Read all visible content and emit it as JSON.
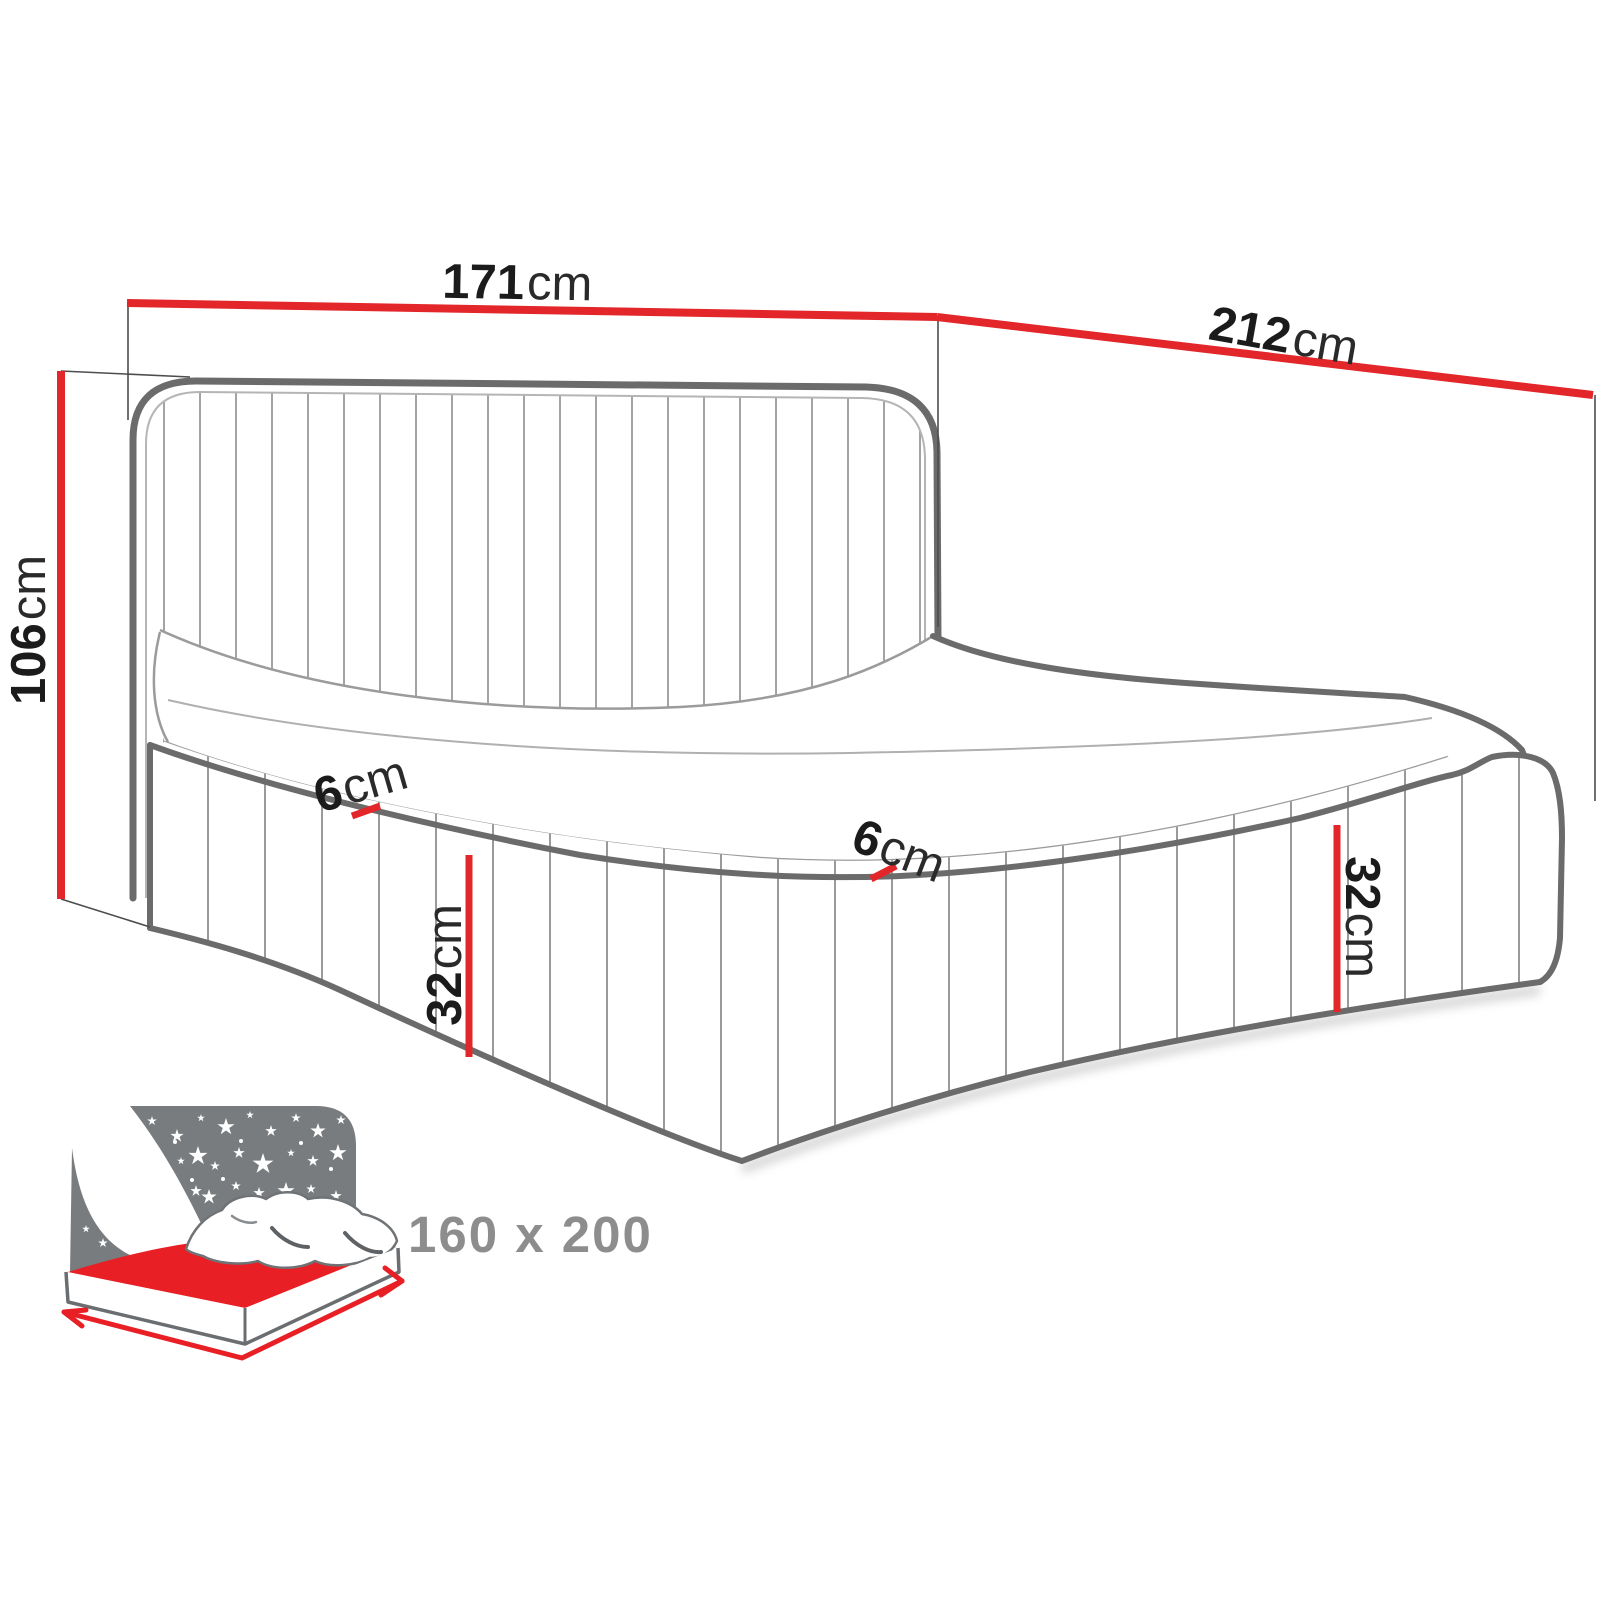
{
  "diagram": {
    "title": "bed-dimension-diagram",
    "dimensions": {
      "width": {
        "value": "171",
        "unit": "cm"
      },
      "length": {
        "value": "212",
        "unit": "cm"
      },
      "height": {
        "value": "106",
        "unit": "cm"
      },
      "rail_left": {
        "value": "6",
        "unit": "cm"
      },
      "rail_right": {
        "value": "6",
        "unit": "cm"
      },
      "frame_left": {
        "value": "32",
        "unit": "cm"
      },
      "frame_right": {
        "value": "32",
        "unit": "cm"
      }
    },
    "badge": {
      "mattress_size": "160 x 200"
    },
    "icon": {
      "name": "storage-bed-icon"
    },
    "colors": {
      "dimension_red": "#e2262a",
      "icon_red": "#e81f24",
      "outline_dark": "#6b6b6b",
      "outline_thin": "#a3a3a3",
      "extension_line": "#4d4d4d",
      "icon_gray": "#797c7e",
      "label_gray": "#8d8d8d",
      "text_black": "#1b1b1b"
    }
  }
}
